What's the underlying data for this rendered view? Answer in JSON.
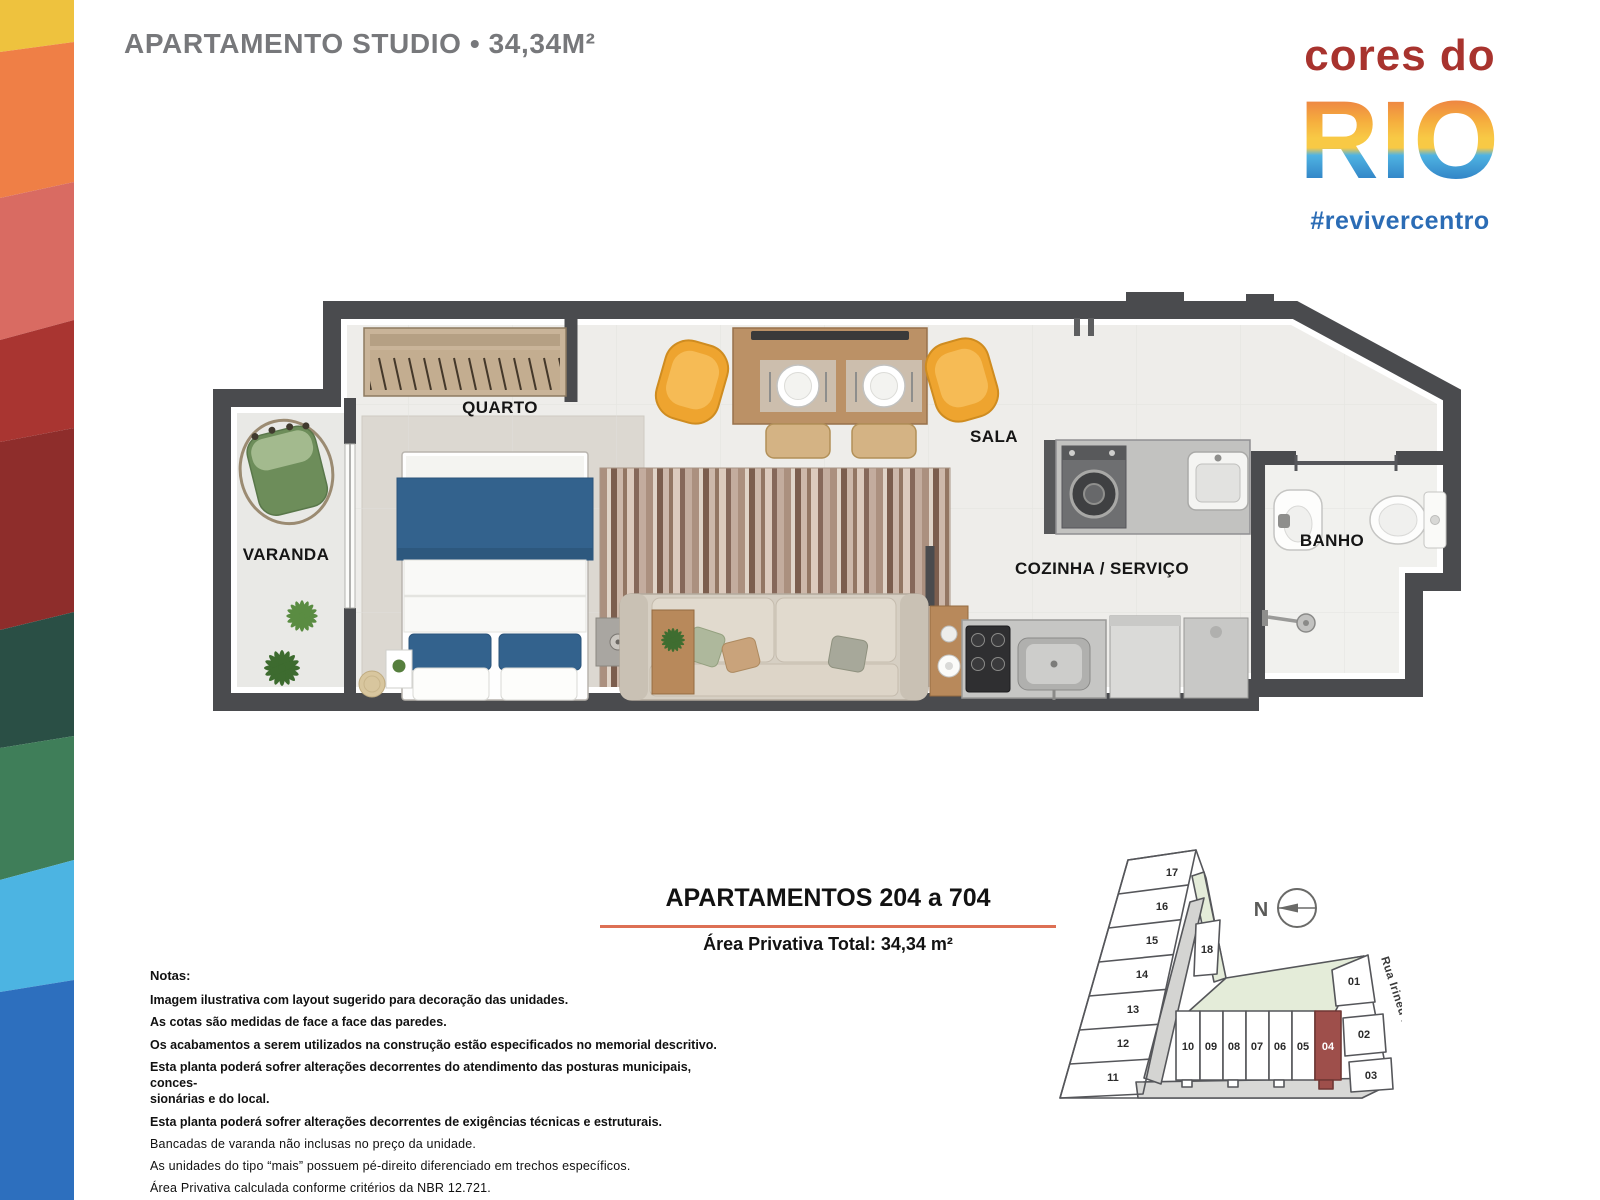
{
  "header": {
    "title": "APARTAMENTO STUDIO • 34,34M²"
  },
  "logo": {
    "top": "cores do",
    "main": "RIO",
    "hashtag": "#revivercentro"
  },
  "floorplan": {
    "rooms": {
      "quarto": "QUARTO",
      "varanda": "VARANDA",
      "sala": "SALA",
      "cozinha": "COZINHA / SERVIÇO",
      "banho": "BANHO"
    }
  },
  "info": {
    "heading": "APARTAMENTOS 204 a 704",
    "area": "Área Privativa Total: 34,34 m²"
  },
  "notes": {
    "title": "Notas:",
    "items": [
      "Imagem ilustrativa com layout sugerido para decoração das unidades.",
      "As cotas são medidas de face a face das paredes.",
      "Os acabamentos a serem utilizados na construção estão especificados no memorial descritivo.",
      "Esta planta poderá sofrer alterações decorrentes do atendimento das posturas municipais, conces-\nsionárias e do local.",
      "Esta planta poderá sofrer alterações decorrentes de exigências técnicas e estruturais.",
      "Bancadas de varanda não inclusas no preço da unidade.",
      "As unidades do tipo “mais” possuem pé-direito diferenciado em trechos específicos.",
      "Área Privativa calculada conforme critérios da NBR 12.721."
    ]
  },
  "siteplan": {
    "units": [
      "01",
      "02",
      "03",
      "04",
      "05",
      "06",
      "07",
      "08",
      "09",
      "10",
      "11",
      "12",
      "13",
      "14",
      "15",
      "16",
      "17",
      "18"
    ],
    "highlighted_unit": "04",
    "street": "Rua Irineu Marinho",
    "north": "N"
  },
  "colors": {
    "accent_line": "#dd7054",
    "highlight_unit": "#9e4f4b",
    "logo_red": "#a8332e",
    "logo_blue": "#2b6cb5",
    "title_gray": "#77787b",
    "wall_gray": "#4a4b4e",
    "strip": [
      "#eec23e",
      "#ef7f46",
      "#d96b62",
      "#a93531",
      "#8e2d2b",
      "#2a4f45",
      "#3f7e59",
      "#4cb4e2",
      "#2d6fbe"
    ]
  }
}
